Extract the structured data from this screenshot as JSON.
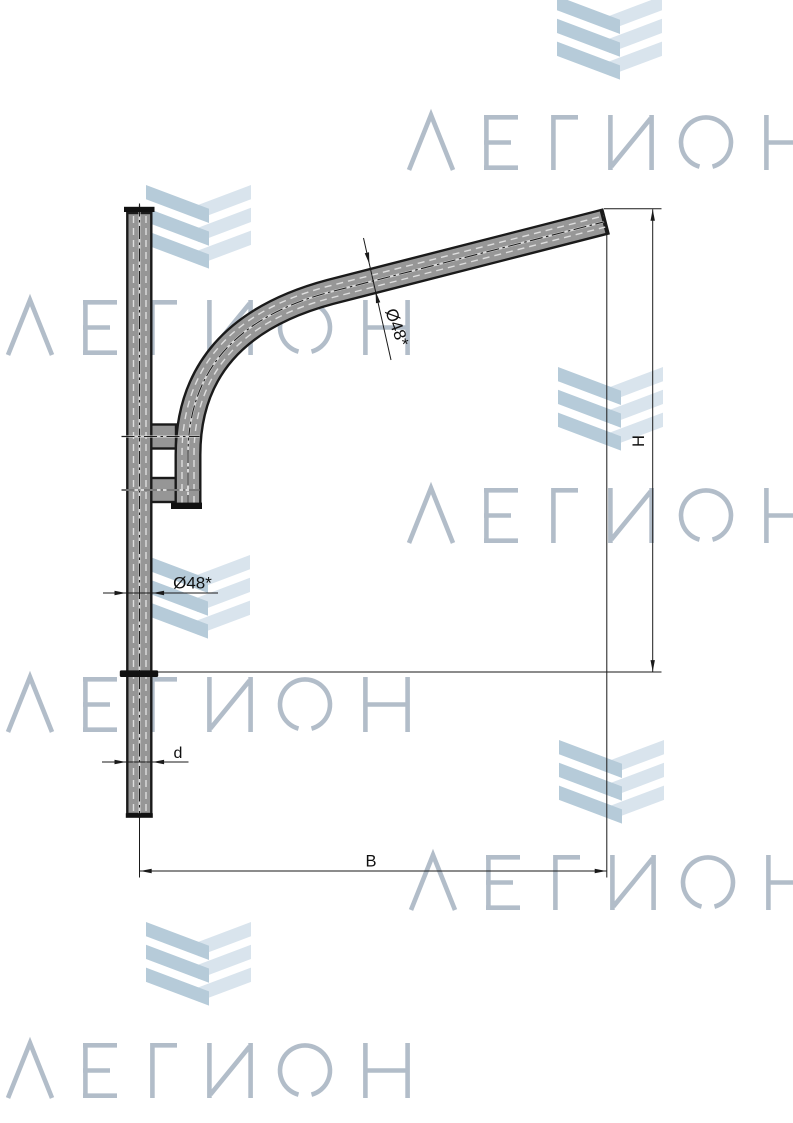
{
  "page": {
    "width_px": 793,
    "height_px": 1123,
    "background": "#ffffff"
  },
  "watermark": {
    "text": "ЛЕГИОН",
    "text_color": "#b2bdc9",
    "chevron_dark_color": "#b6cbd9",
    "chevron_light_color": "#d9e4ed",
    "text_instances": 6,
    "chevron_instances": 6
  },
  "drawing": {
    "tube_fill_color": "#969696",
    "outline_color": "#1a1a1a",
    "labels": {
      "arm_diameter": "Ø48*",
      "pole_diameter": "Ø48*",
      "height": "H",
      "reach": "B",
      "mount_diameter": "d"
    }
  }
}
